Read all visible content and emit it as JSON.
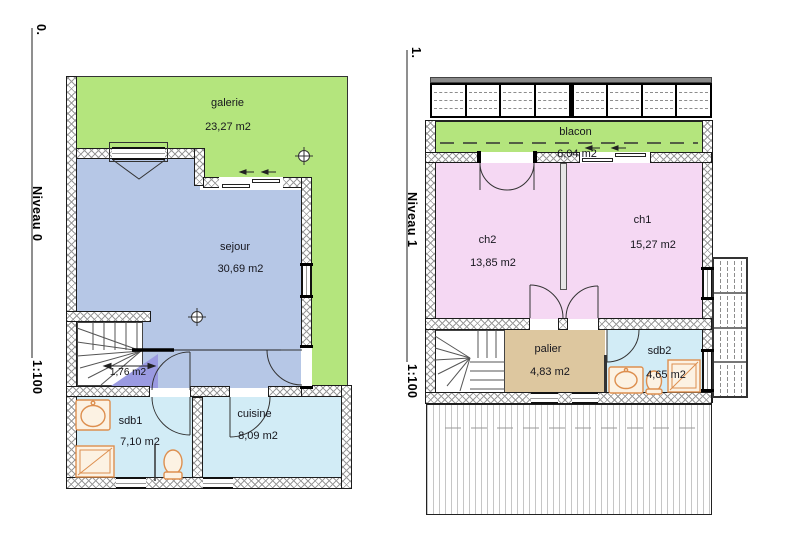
{
  "document": {
    "type": "architectural floor plans",
    "background": "#ffffff"
  },
  "colors": {
    "galerie_green": "#b4e57d",
    "sejour_blue": "#b6c7e6",
    "bedroom_pink": "#f5d8f3",
    "wet_room_cyan": "#d2ecf6",
    "palier_tan": "#ddc79f",
    "vestibule_purple": "#9a9ae1",
    "fixture_orange": "#dd8f4f",
    "wall_line": "#1c1c1c"
  },
  "left_plan": {
    "axis_label": "0.",
    "level_label": "Niveau 0",
    "scale_label": "1:100",
    "rooms": [
      {
        "name": "galerie",
        "area": "23,27 m2"
      },
      {
        "name": "sejour",
        "area": "30,69 m2"
      },
      {
        "name": "",
        "area": "1,76 m2"
      },
      {
        "name": "sdb1",
        "area": "7,10 m2"
      },
      {
        "name": "cuisine",
        "area": "8,09 m2"
      }
    ]
  },
  "right_plan": {
    "axis_label": "1.",
    "level_label": "Niveau 1",
    "scale_label": "1:100",
    "rooms": [
      {
        "name": "blacon",
        "area": "6,04 m2"
      },
      {
        "name": "ch2",
        "area": "13,85 m2"
      },
      {
        "name": "ch1",
        "area": "15,27 m2"
      },
      {
        "name": "palier",
        "area": "4,83 m2"
      },
      {
        "name": "sdb2",
        "area": "4,65 m2"
      }
    ]
  }
}
